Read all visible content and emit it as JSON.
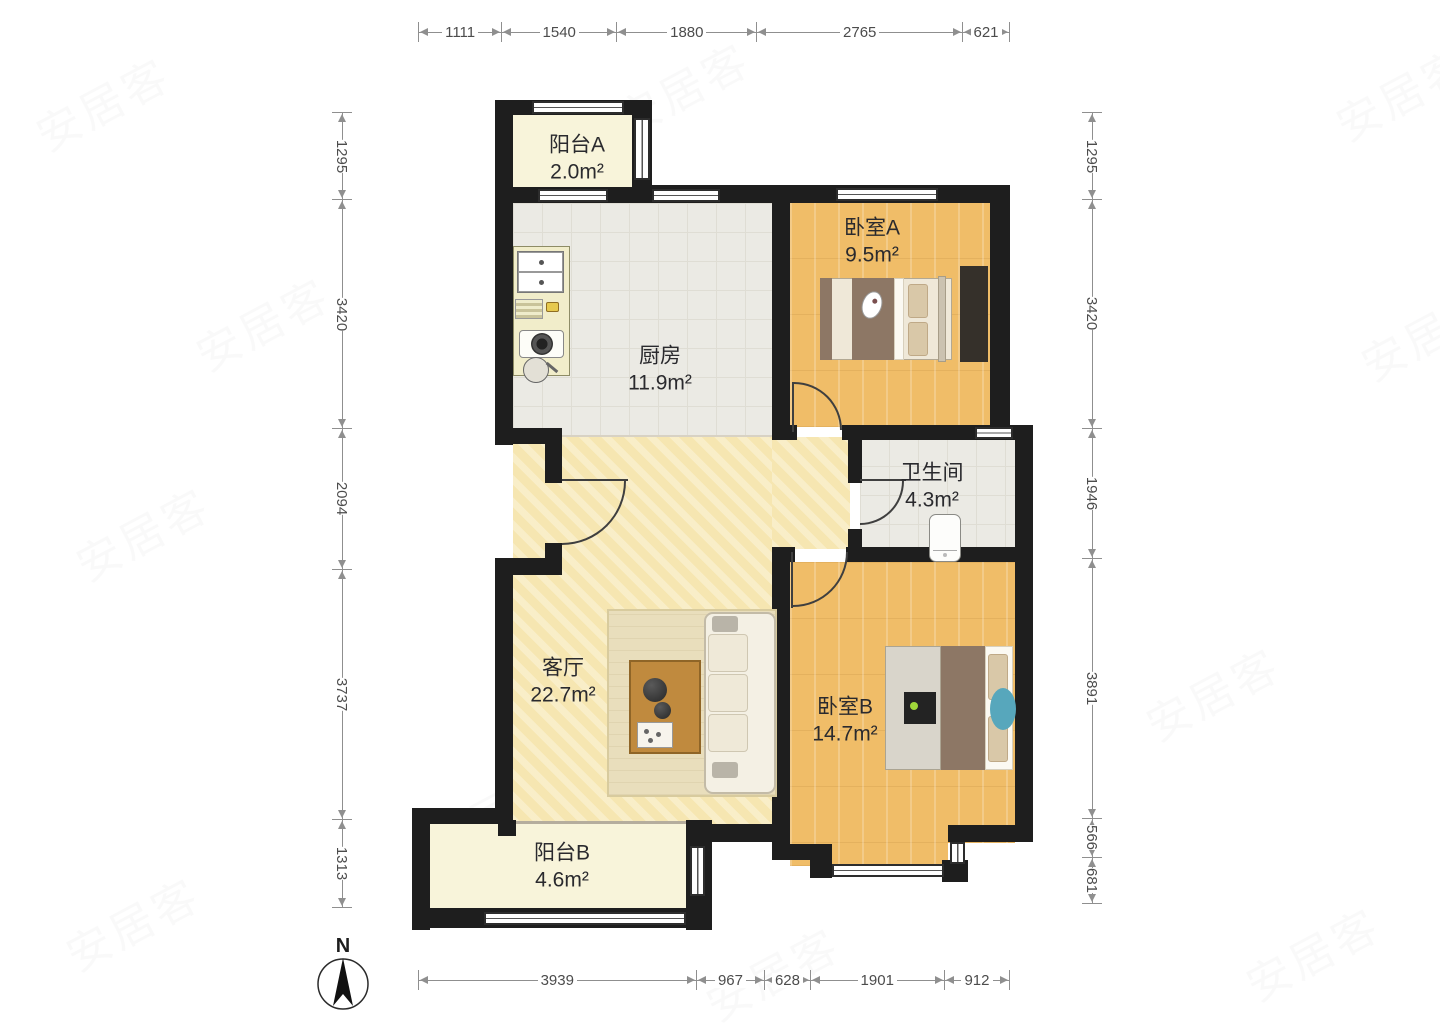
{
  "dimensions": {
    "top": [
      1111,
      1540,
      1880,
      2765,
      621
    ],
    "bottom": [
      3939,
      967,
      628,
      1901,
      912
    ],
    "left": [
      1295,
      3420,
      2094,
      3737,
      1313
    ],
    "right": [
      1295,
      3420,
      1946,
      3891,
      566,
      681
    ]
  },
  "rooms": [
    {
      "name": "阳台A",
      "area": "2.0m²"
    },
    {
      "name": "厨房",
      "area": "11.9m²"
    },
    {
      "name": "卧室A",
      "area": "9.5m²"
    },
    {
      "name": "卫生间",
      "area": "4.3m²"
    },
    {
      "name": "客厅",
      "area": "22.7m²"
    },
    {
      "name": "卧室B",
      "area": "14.7m²"
    },
    {
      "name": "阳台B",
      "area": "4.6m²"
    }
  ],
  "compass": {
    "label": "N"
  },
  "watermark": {
    "text": "安居客"
  },
  "colors": {
    "bg": "#ffffff",
    "wall": "#1e1e1e",
    "wood": "#f0bd68",
    "living": "#f6e6b1",
    "tile": "#ebeae4",
    "balcony": "#f8f4da"
  }
}
